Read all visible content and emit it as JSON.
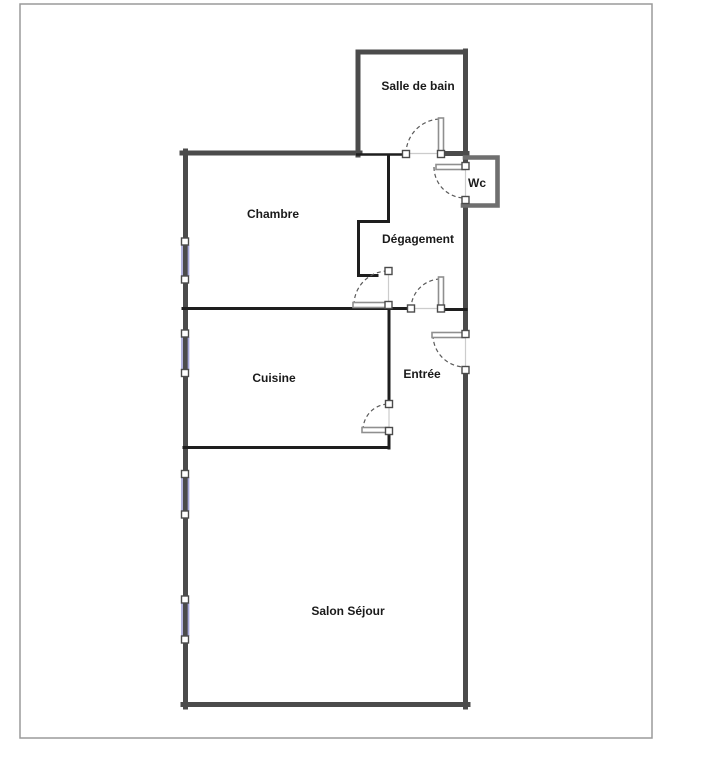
{
  "colors": {
    "background": "#ffffff",
    "page-border": "#9a9a9a",
    "outer-wall": "#4b4b4b",
    "inner-wall": "#1e1e1e",
    "wc-wall": "#6f6f6f",
    "door-leaf": "#8f8f8f",
    "door-dash": "#5a5a5a",
    "threshold": "#cccccc",
    "window-glass": "#a6a6d9",
    "post-fill": "#ffffff",
    "post-border": "#4b4b4b",
    "label-text": "#1a1a1a"
  },
  "rooms": [
    {
      "label": "Salle de bain"
    },
    {
      "label": "Wc"
    },
    {
      "label": "Chambre"
    },
    {
      "label": "Dégagement"
    },
    {
      "label": "Cuisine"
    },
    {
      "label": "Entrée"
    },
    {
      "label": "Salon Séjour"
    }
  ]
}
